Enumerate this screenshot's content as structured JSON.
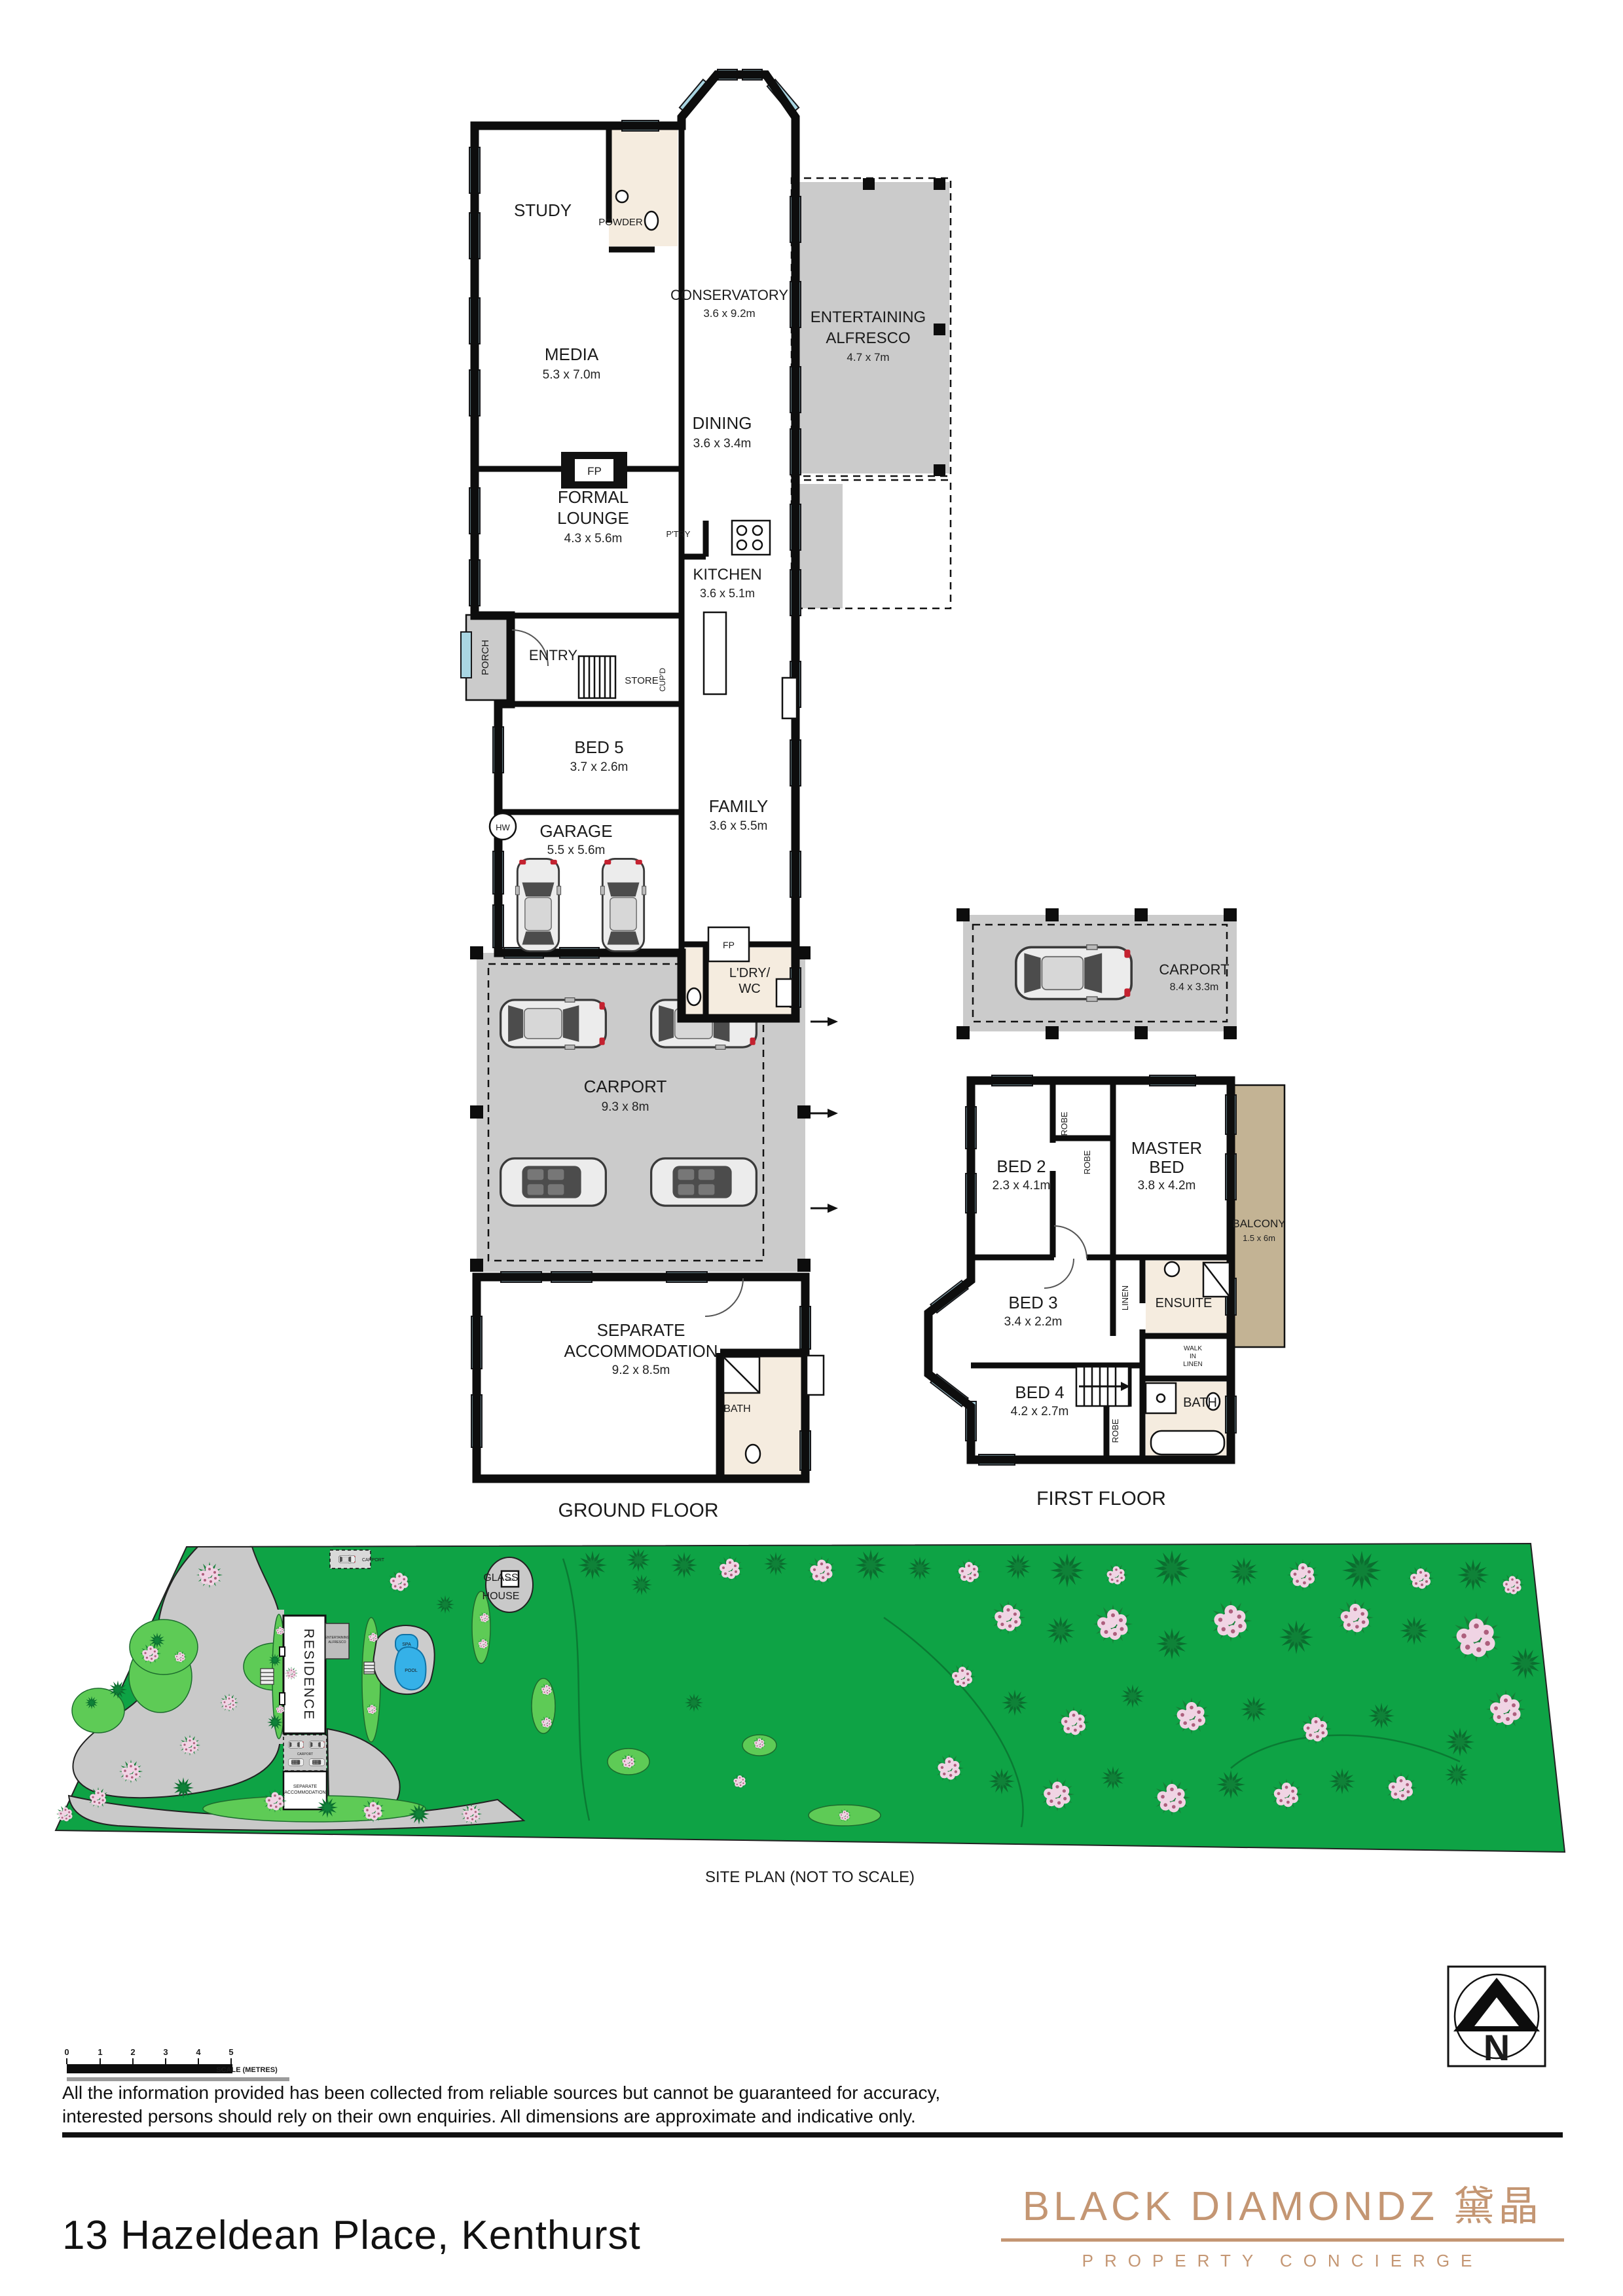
{
  "ground_floor": {
    "caption": "GROUND FLOOR",
    "study": "STUDY",
    "powder": "POWDER",
    "media_name": "MEDIA",
    "media_dims": "5.3 x 7.0m",
    "conservatory_name": "CONSERVATORY",
    "conservatory_dims": "3.6 x 9.2m",
    "alfresco_l1": "ENTERTAINING",
    "alfresco_l2": "ALFRESCO",
    "alfresco_dims": "4.7 x 7m",
    "fp_media": "FP",
    "dining_name": "DINING",
    "dining_dims": "3.6 x 3.4m",
    "lounge_l1": "FORMAL",
    "lounge_l2": "LOUNGE",
    "lounge_dims": "4.3 x 5.6m",
    "kitchen_name": "KITCHEN",
    "kitchen_dims": "3.6 x 5.1m",
    "pantry": "P'TRY",
    "porch": "PORCH",
    "entry": "ENTRY",
    "store": "STORE",
    "cupd": "CUP'D",
    "bed5_name": "BED 5",
    "bed5_dims": "3.7 x 2.6m",
    "hw": "HW",
    "garage_name": "GARAGE",
    "garage_dims": "5.5 x 5.6m",
    "family_name": "FAMILY",
    "family_dims": "3.6 x 5.5m",
    "fp_family": "FP",
    "laundry_l1": "L'DRY/",
    "laundry_l2": "WC",
    "carport_name": "CARPORT",
    "carport_dims": "9.3 x 8m",
    "sepacc_l1": "SEPARATE",
    "sepacc_l2": "ACCOMMODATION",
    "sepacc_dims": "9.2 x 8.5m",
    "bath": "BATH"
  },
  "first_floor": {
    "caption": "FIRST FLOOR",
    "carport_name": "CARPORT",
    "carport_dims": "8.4 x 3.3m",
    "bed2_name": "BED 2",
    "bed2_dims": "2.3 x 4.1m",
    "robe_a": "ROBE",
    "robe_b": "ROBE",
    "robe_c": "ROBE",
    "master_l1": "MASTER",
    "master_l2": "BED",
    "master_dims": "3.8 x 4.2m",
    "balcony_name": "BALCONY",
    "balcony_dims": "1.5 x 6m",
    "bed3_name": "BED 3",
    "bed3_dims": "3.4 x 2.2m",
    "linen": "LINEN",
    "ensuite": "ENSUITE",
    "wil_l1": "WALK",
    "wil_l2": "IN",
    "wil_l3": "LINEN",
    "bed4_name": "BED 4",
    "bed4_dims": "4.2 x 2.7m",
    "bath": "BATH"
  },
  "site_plan": {
    "caption": "SITE PLAN (NOT TO SCALE)",
    "glass_l1": "GLASS",
    "glass_l2": "HOUSE",
    "shed": "SHED",
    "carport_top": "CARPORT",
    "residence": "RESIDENCE",
    "alfresco_l1": "ENTERTAINING",
    "alfresco_l2": "ALFRESCO",
    "spa": "SPA",
    "pool": "POOL",
    "carport_mid": "CARPORT",
    "sepacc_l1": "SEPARATE",
    "sepacc_l2": "ACCOMMODATION"
  },
  "scale_bar": {
    "t0": "0",
    "t1": "1",
    "t2": "2",
    "t3": "3",
    "t4": "4",
    "t5": "5",
    "label": "SCALE (METRES)"
  },
  "north": {
    "label": "N"
  },
  "disclaimer": {
    "line1": "All the information provided has been collected from reliable sources but cannot be guaranteed for accuracy,",
    "line2": "interested persons should rely on their own enquiries. All dimensions are approximate and indicative only."
  },
  "footer": {
    "address": "13 Hazeldean Place, Kenthurst",
    "brand": "BLACK DIAMONDZ 黛晶",
    "tagline": "PROPERTY CONCIERGE"
  },
  "colors": {
    "window_blue": "#a9d6e3",
    "carport_grey": "#cbcbcb",
    "balcony_tan": "#c3b394",
    "site_green": "#0ea345",
    "brand_copper": "#c49673"
  }
}
